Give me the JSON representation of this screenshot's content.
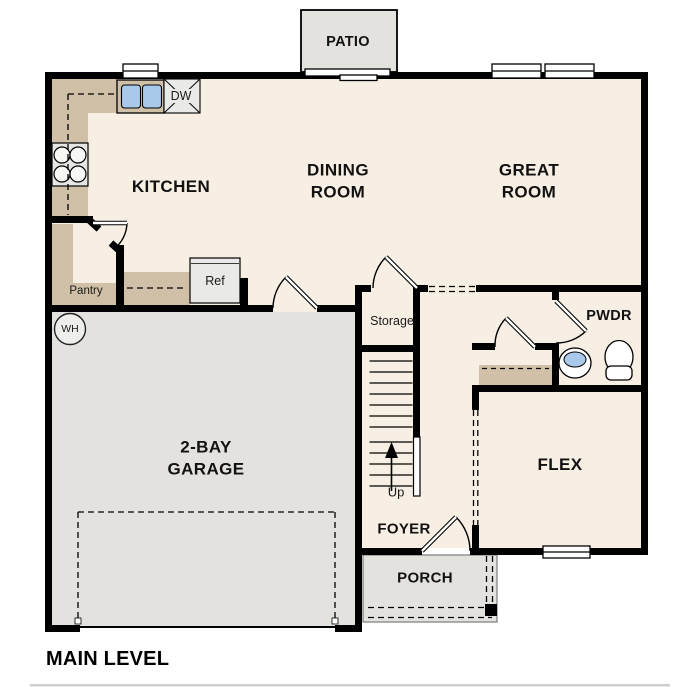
{
  "plan": {
    "title": "MAIN LEVEL",
    "rooms": {
      "patio": "PATIO",
      "kitchen": "KITCHEN",
      "dining": "DINING\nROOM",
      "great": "GREAT\nROOM",
      "garage": "2-BAY\nGARAGE",
      "flex": "FLEX",
      "foyer": "FOYER",
      "porch": "PORCH",
      "powder": "PWDR",
      "storage": "Storage",
      "pantry": "Pantry"
    },
    "fixtures": {
      "dishwasher": "DW",
      "refrigerator": "Ref",
      "water_heater": "WH",
      "stairs_direction": "Up"
    },
    "colors": {
      "floor": "#f7efe3",
      "garage_floor": "#e4e2df",
      "outdoor": "#e3e2df",
      "counter": "#cfc0a7",
      "appliance": "#e9e9e7",
      "sink": "#a9c9ea",
      "wall": "#000000"
    }
  }
}
